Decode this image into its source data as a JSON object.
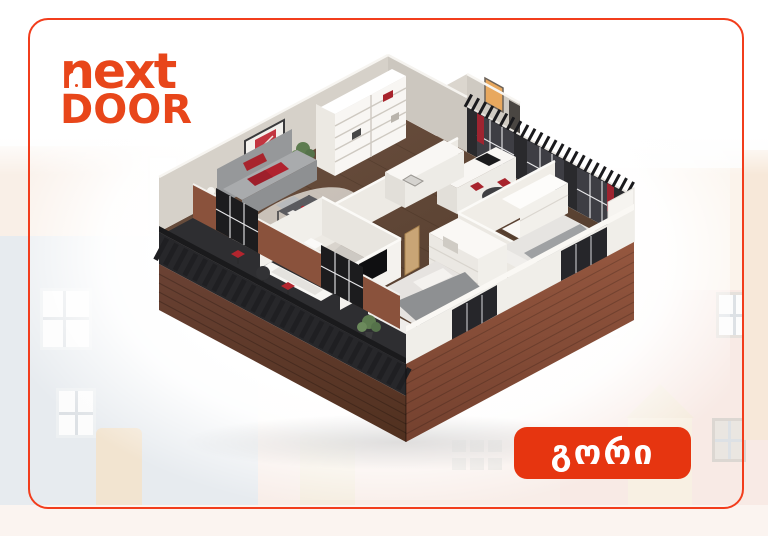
{
  "page": {
    "background_color": "#FFFFFF"
  },
  "card": {
    "border_color": "#F23D1C",
    "corner_radius_px": 20
  },
  "logo": {
    "line1": "next",
    "line2": "DOOR",
    "color": "#E8461A",
    "door_mark": "door-cut-in-letter-n"
  },
  "badge": {
    "label": "გორი",
    "background_color": "#E63510",
    "text_color": "#FFFFFF"
  },
  "floorplan": {
    "type": "3d-isometric-apartment-render",
    "rooms": [
      "hallway",
      "living-room",
      "kitchen",
      "dining-area",
      "bathroom",
      "bedroom-1",
      "bedroom-2",
      "balcony"
    ],
    "palette": {
      "wood_floor": "#5E4534",
      "brick_facade": "#8A523C",
      "walls": "#E9E6E0",
      "dark_frames": "#232326",
      "accent_red": "#B0222E",
      "sofa_gray": "#A9ABAD"
    }
  },
  "background": {
    "illustration": "faded-row-houses",
    "colors": {
      "blue_house": "#E7EBEF",
      "pink_house": "#F8EDE8",
      "cream_house": "#FBF3EB"
    }
  }
}
